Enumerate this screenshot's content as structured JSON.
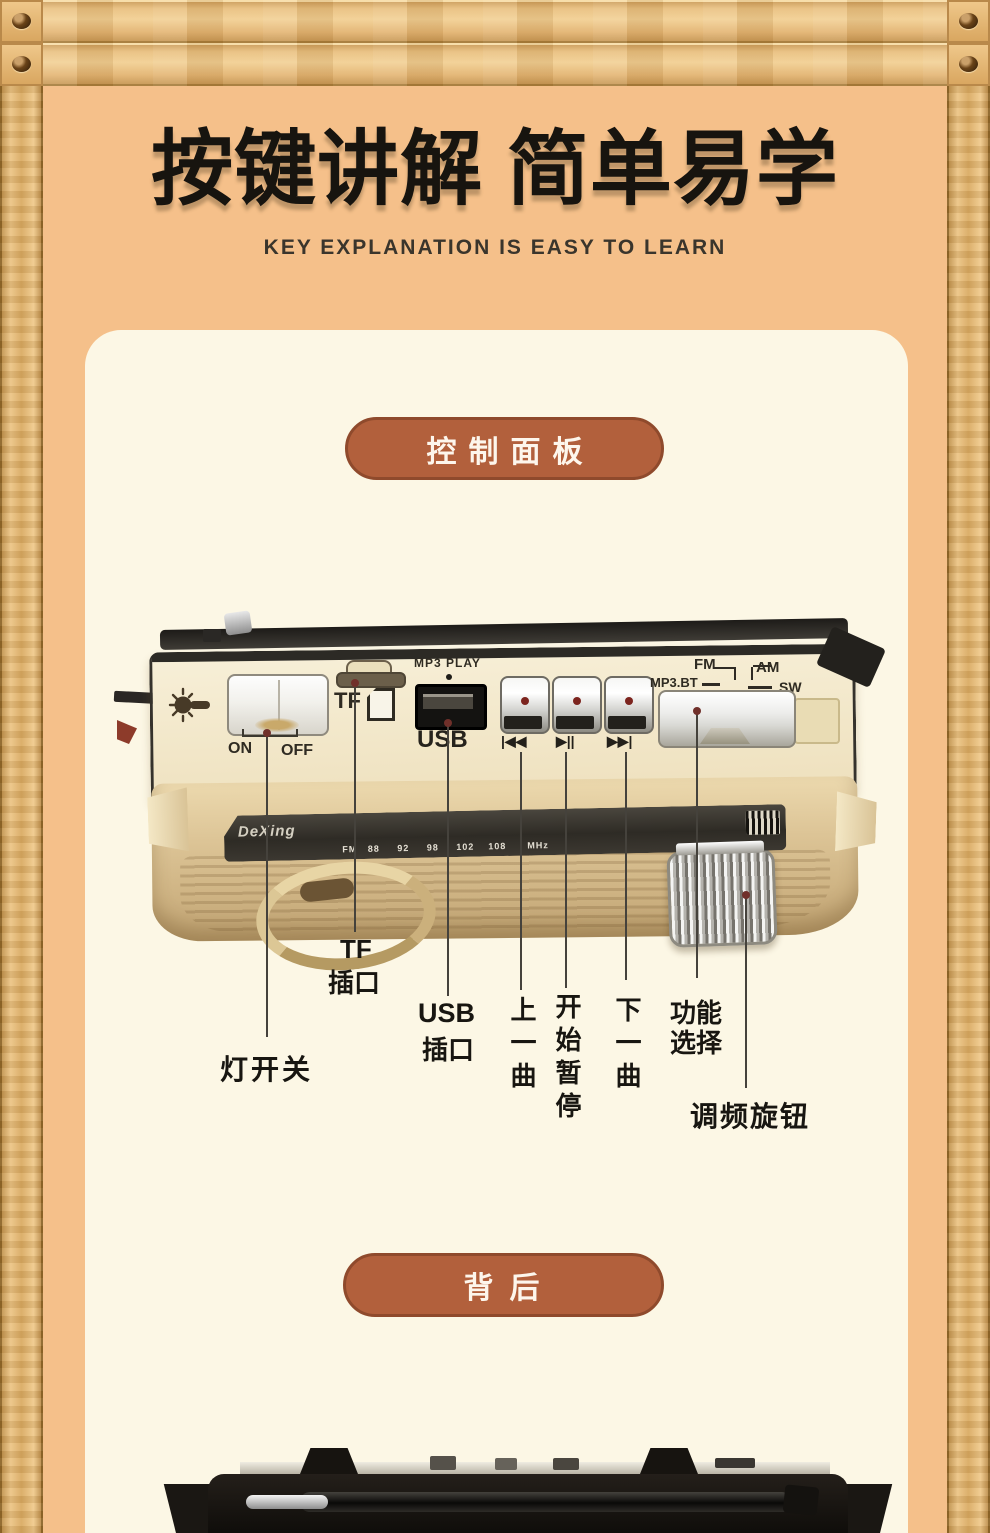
{
  "header": {
    "title": "按键讲解 简单易学",
    "subtitle": "KEY EXPLANATION IS EASY TO LEARN"
  },
  "badges": {
    "control_panel": "控制面板",
    "back": "背后"
  },
  "device": {
    "brand": "DeXing",
    "labels": {
      "mp3_play": "MP3 PLAY",
      "tf": "TF",
      "usb": "USB",
      "on": "ON",
      "off": "OFF",
      "prev": "|◀◀",
      "play_pause": "▶||",
      "next": "▶▶|",
      "mp3_bt": "MP3.BT",
      "fm": "FM",
      "am": "AM",
      "sw": "SW"
    },
    "dial": {
      "fm_row": "FM   88     92     98     102    108      MHz",
      "am_row": "AM   530    700    1000   1100   1400   1600",
      "sw_row": "SW   5.5    7.5    10.2   13.2   16.0   18.6  MHz"
    }
  },
  "callouts": {
    "light_switch": "灯开关",
    "tf_line1": "TF",
    "tf_line2": "插口",
    "usb_line1": "USB",
    "usb_line2": "插口",
    "prev_track": "上一曲",
    "play_pause": "开始暂停",
    "next_track": "下一曲",
    "function_line1": "功能",
    "function_line2": "选择",
    "tuning_knob": "调频旋钮"
  },
  "colors": {
    "accent_pill": "#b2603c",
    "background": "#f5c08a",
    "panel": "#fcf7e5"
  }
}
